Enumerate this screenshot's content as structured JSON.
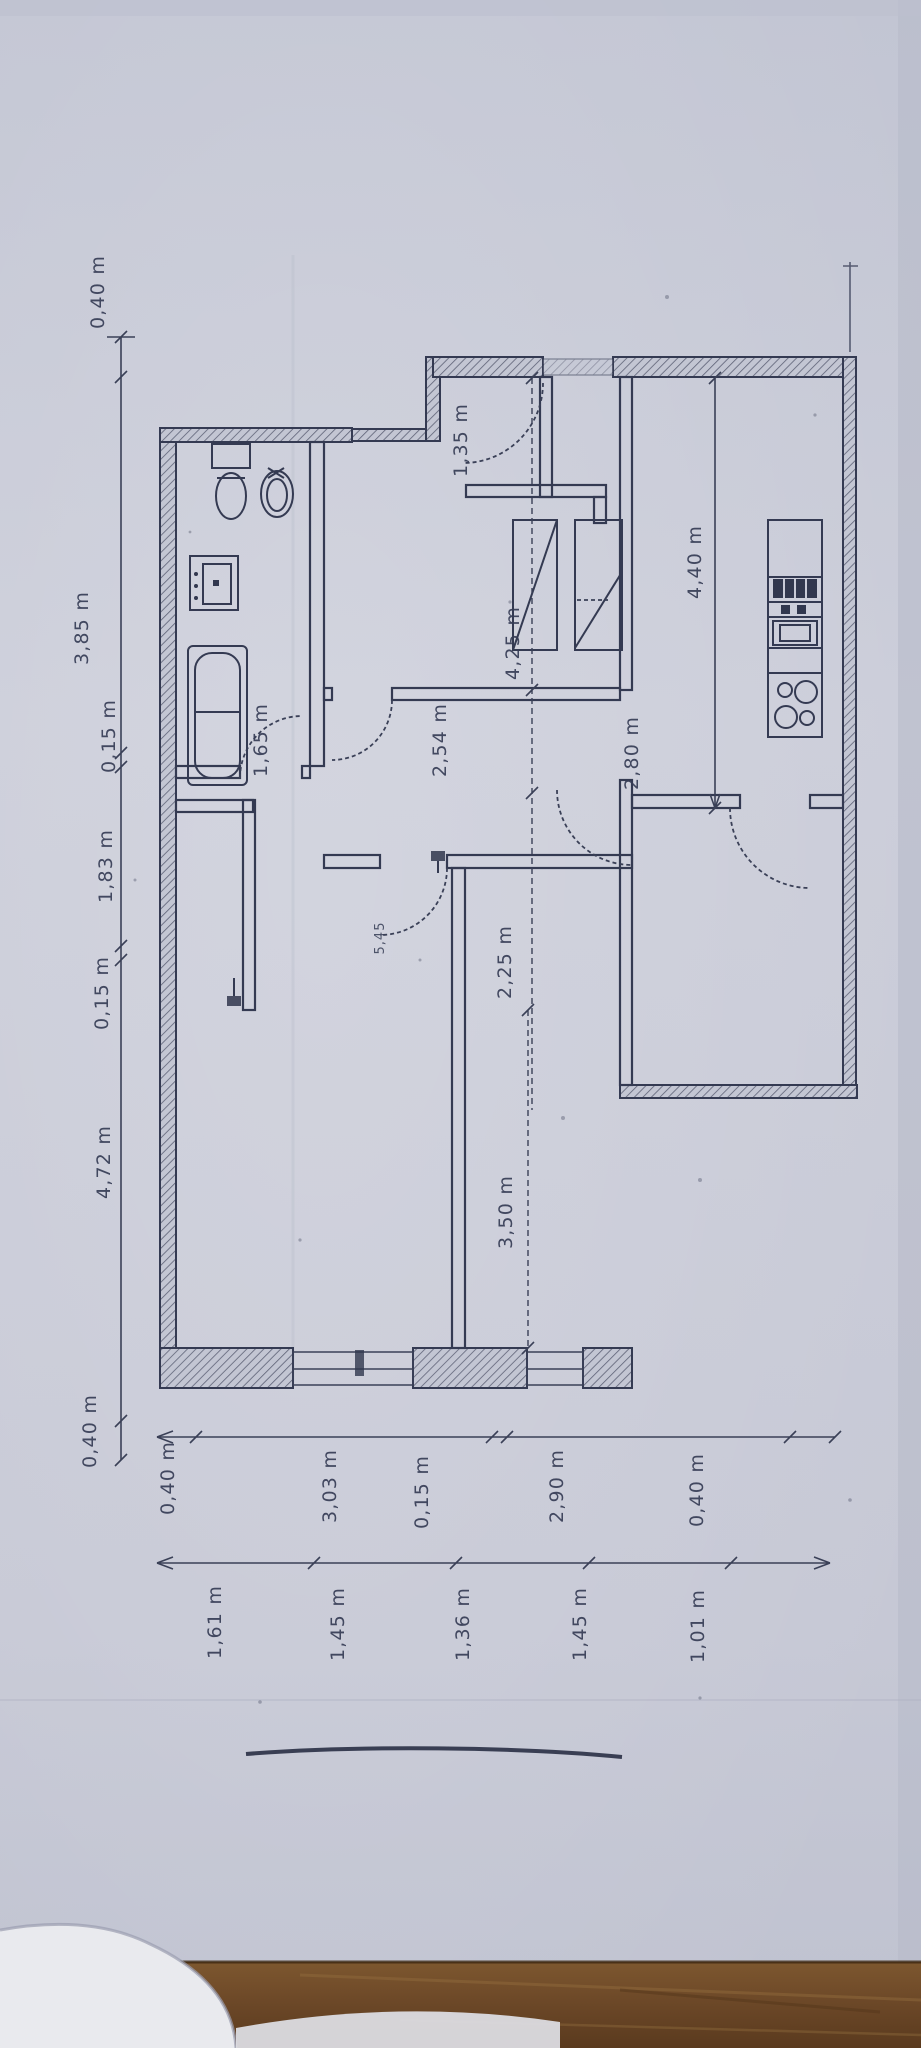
{
  "plan": {
    "dim_left": [
      "0,40 m",
      "3,85 m",
      "0,15 m",
      "1,83 m",
      "0,15 m",
      "4,72 m",
      "0,40 m"
    ],
    "dim_bottom_outer": [
      "0,40 m",
      "3,03 m",
      "0,15 m",
      "2,90 m",
      "0,40 m"
    ],
    "dim_bottom_inner": [
      "1,61 m",
      "1,45 m",
      "1,36 m",
      "1,45 m",
      "1,01 m"
    ],
    "rooms": {
      "entry": "1,35 m",
      "bath_passage": "1,65 m",
      "hall_upper": "2,54 m",
      "room_top": "4,25 m",
      "kitchen": "4,40 m",
      "room_right": "2,80 m",
      "hall_lower": "2,25 m",
      "hall_small": "5,45",
      "room_bottom": "3,50 m"
    }
  },
  "colors": {
    "paper": "#c8cad7",
    "ink": "#343a52",
    "wood": "#6b4727"
  }
}
